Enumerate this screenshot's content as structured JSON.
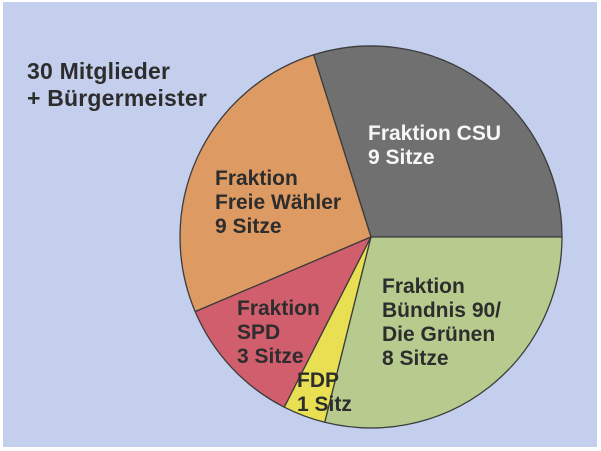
{
  "title": {
    "lines": [
      "30 Mitglieder",
      "+ Bürgermeister"
    ]
  },
  "colors": {
    "page_background": "#ffffff",
    "panel_background": "#c3cfec",
    "title_text": "#2d2d2d",
    "slice_outline": "#3c3c3c"
  },
  "chart_data": {
    "type": "pie",
    "title": "30 Mitglieder + Bürgermeister",
    "unit": "Sitze",
    "total_seats": 30,
    "categories": [
      "Fraktion CSU",
      "Fraktion Freie Wähler",
      "Fraktion SPD",
      "FDP",
      "Fraktion Bündnis 90/Die Grünen"
    ],
    "values": [
      9,
      9,
      3,
      1,
      8
    ],
    "legend_position": "labels-inside-slices",
    "center": {
      "x": 371,
      "y": 237
    },
    "radius": 191,
    "outline_color": "#3c3c3c",
    "slices": [
      {
        "id": "csu",
        "name": "Fraktion CSU",
        "seats": 9,
        "label_lines": [
          "Fraktion CSU",
          "9 Sitze"
        ],
        "color": "#707070",
        "text_color": "#f7f7f7",
        "start_angle": 0,
        "end_angle": 107.5,
        "label_x": 368,
        "label_y": 122
      },
      {
        "id": "freie-waehler",
        "name": "Fraktion Freie Wähler",
        "seats": 9,
        "label_lines": [
          "Fraktion",
          "Freie Wähler",
          "9 Sitze"
        ],
        "color": "#dd9a63",
        "text_color": "#2d2d2d",
        "start_angle": 107.5,
        "end_angle": 203,
        "label_x": 215,
        "label_y": 167
      },
      {
        "id": "spd",
        "name": "Fraktion SPD",
        "seats": 3,
        "label_lines": [
          "Fraktion",
          "SPD",
          "3 Sitze"
        ],
        "color": "#d05e6c",
        "text_color": "#2d2d2d",
        "start_angle": 203,
        "end_angle": 243,
        "label_x": 237,
        "label_y": 297
      },
      {
        "id": "fdp",
        "name": "FDP",
        "seats": 1,
        "label_lines": [
          "FDP",
          "1 Sitz"
        ],
        "color": "#e8e052",
        "text_color": "#2d2d2d",
        "start_angle": 243,
        "end_angle": 256,
        "label_x": 297,
        "label_y": 369
      },
      {
        "id": "gruene",
        "name": "Fraktion Bündnis 90/Die Grünen",
        "seats": 8,
        "label_lines": [
          "Fraktion",
          "Bündnis 90/",
          "Die Grünen",
          "8 Sitze"
        ],
        "color": "#b7cb8e",
        "text_color": "#2d2d2d",
        "start_angle": 256,
        "end_angle": 360,
        "label_x": 382,
        "label_y": 275
      }
    ]
  }
}
